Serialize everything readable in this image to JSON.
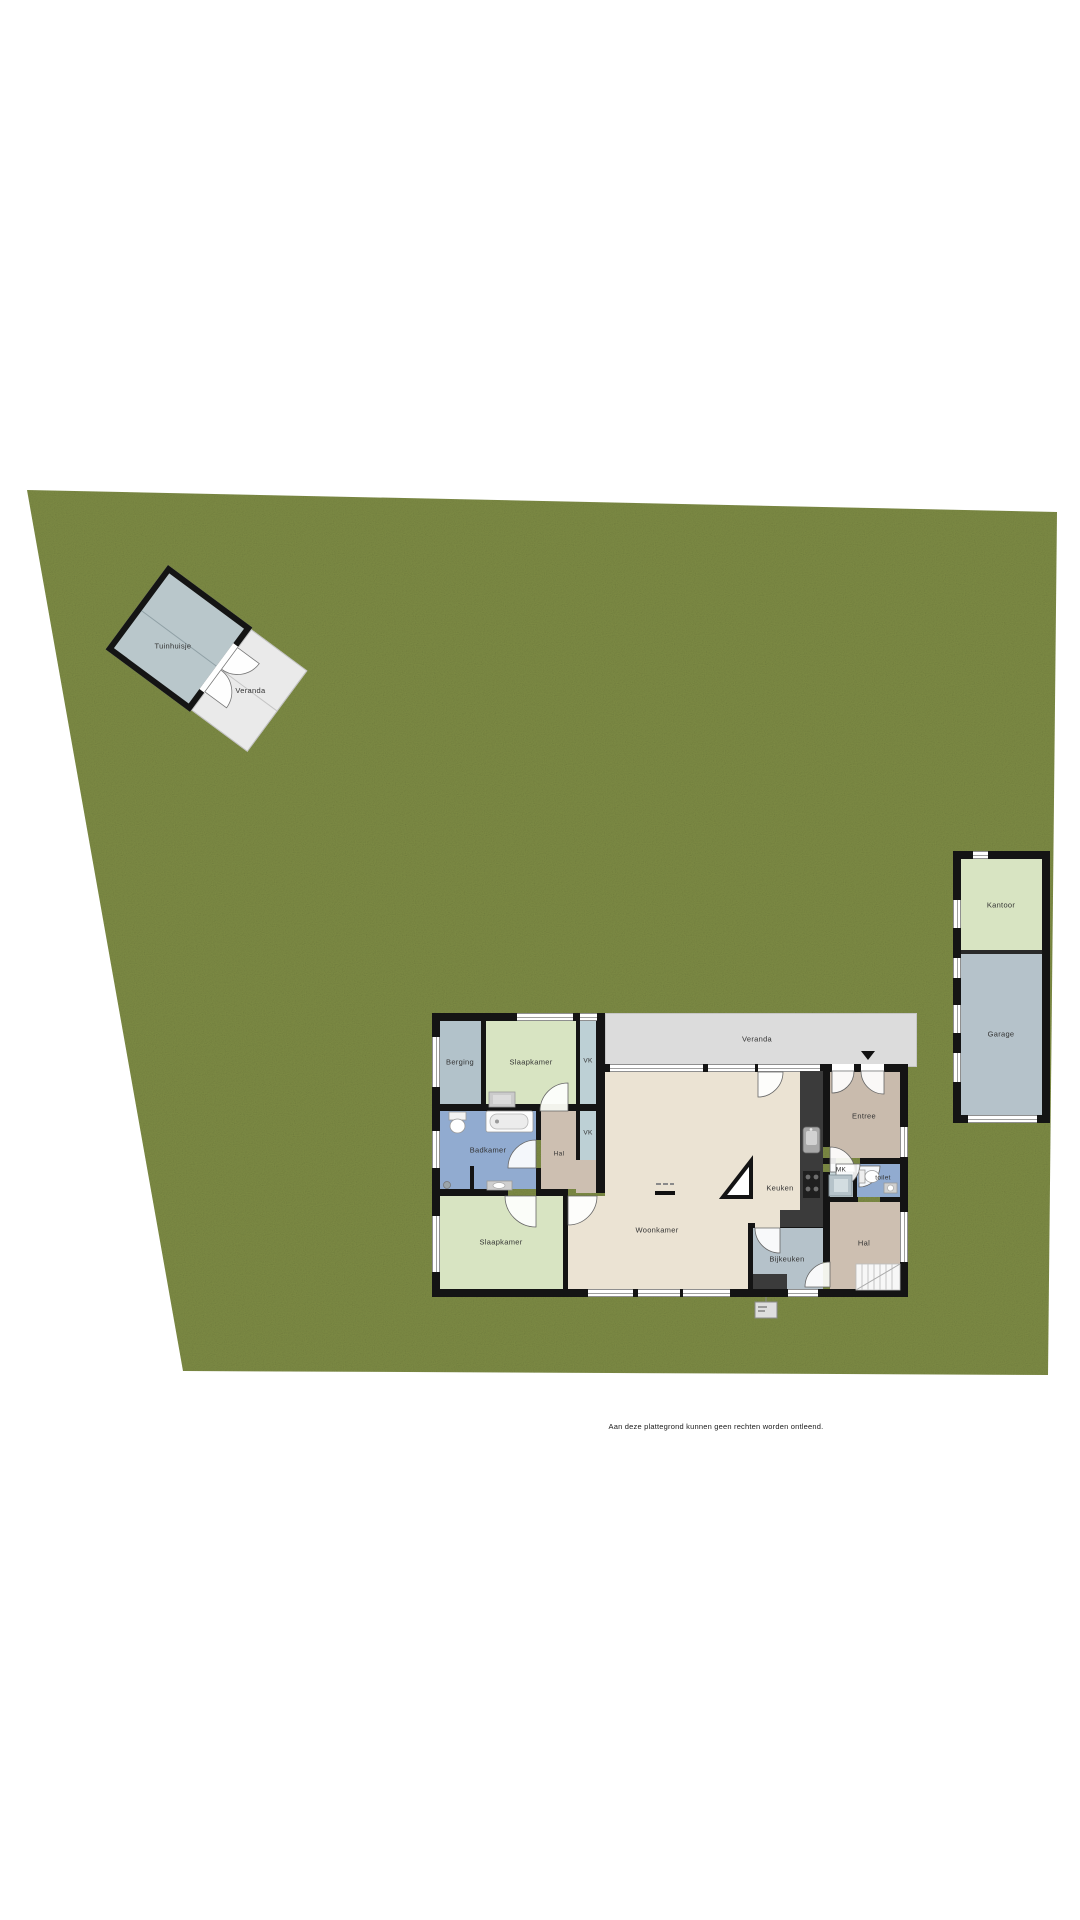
{
  "page": {
    "footer_note": "Aan deze plattegrond kunnen geen rechten worden ontleend."
  },
  "shed": {
    "name": "Tuinhuisje",
    "veranda": "Veranda"
  },
  "annex": {
    "kantoor": "Kantoor",
    "garage": "Garage"
  },
  "house": {
    "veranda": "Veranda",
    "berging": "Berging",
    "slaapkamer_boven": "Slaapkamer",
    "vk1": "VK",
    "vk2": "VK",
    "badkamer": "Badkamer",
    "hal_klein": "Hal",
    "slaapkamer_onder": "Slaapkamer",
    "woonkamer": "Woonkamer",
    "keuken": "Keuken",
    "entree": "Entree",
    "mk": "MK",
    "toilet": "toilet",
    "hal_groot": "Hal",
    "bijkeuken": "Bijkeuken"
  },
  "colors": {
    "grass": "#7d8b44",
    "floor_beige": "#ebe3d3",
    "bedroom_green": "#d8e4c2",
    "bath_blue": "#91abd0",
    "utility_bluegrey": "#b5c2ca",
    "hall_tan": "#cdbfb1",
    "entree_tan": "#c9bbad",
    "veranda_grey": "#dcdcdc",
    "wall_black": "#141414"
  }
}
